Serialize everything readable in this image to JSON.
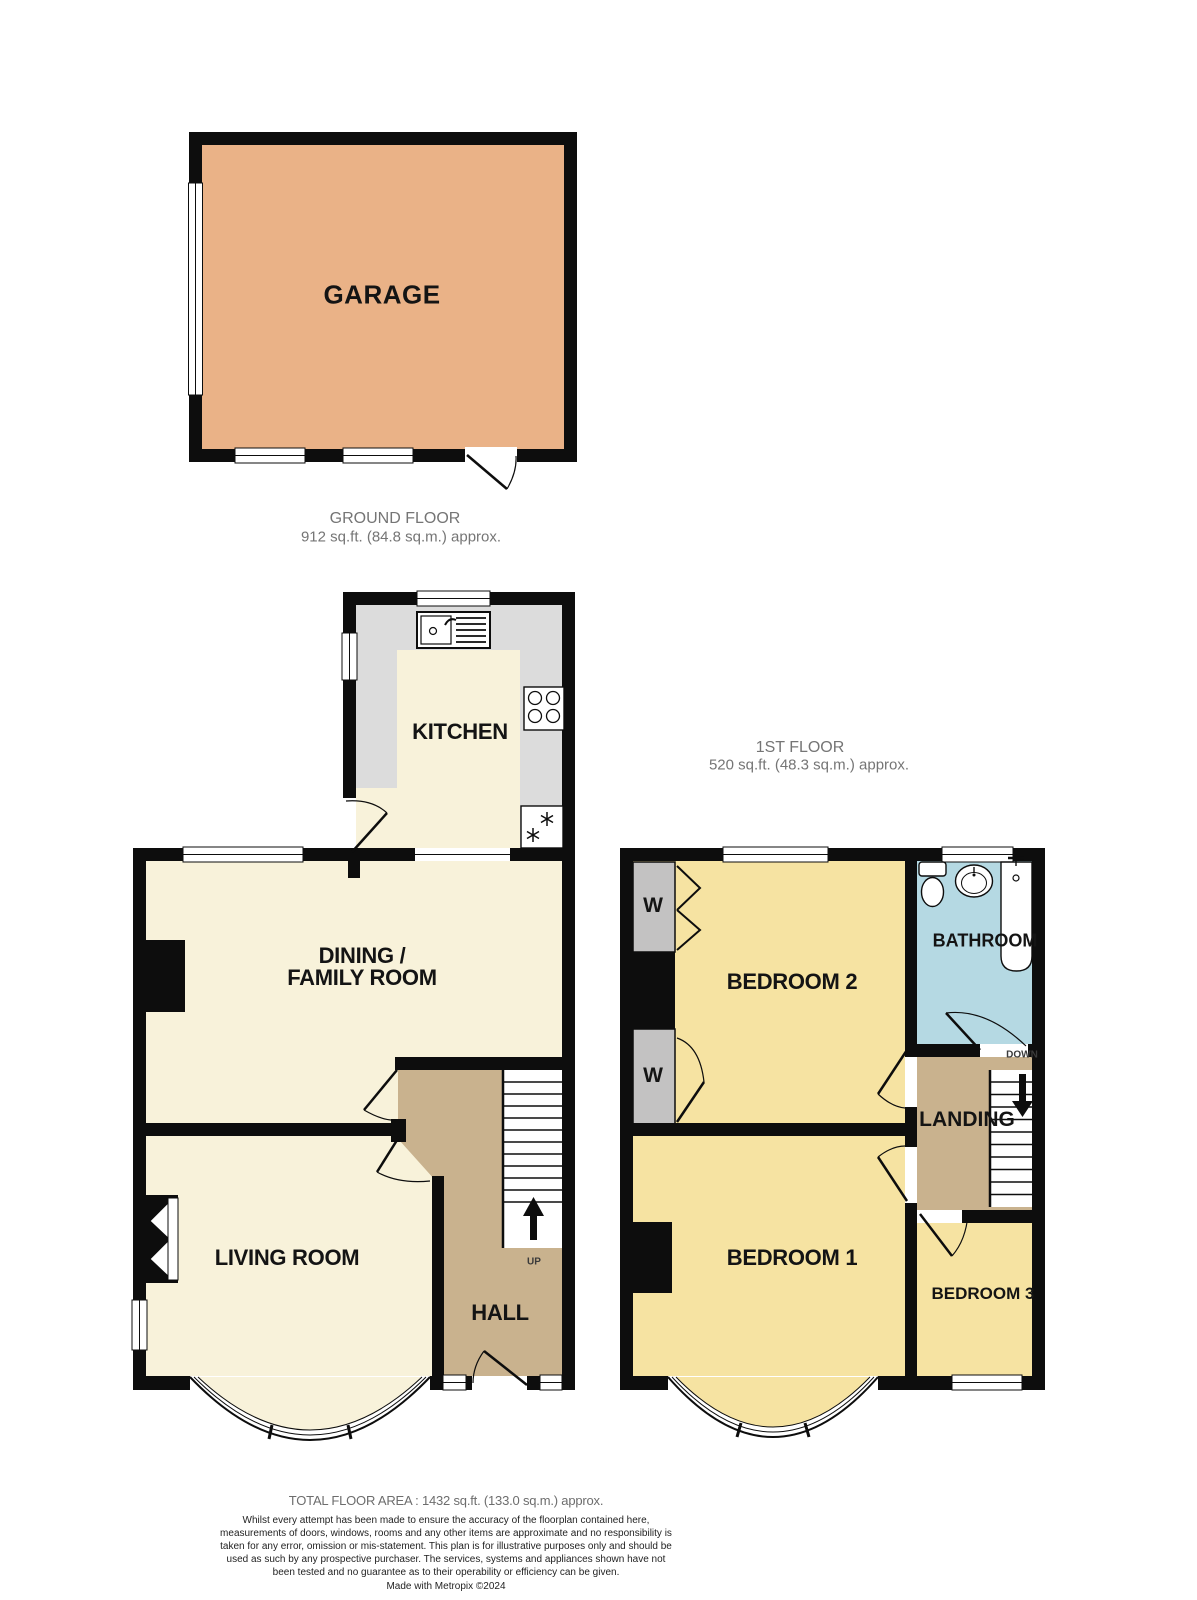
{
  "document": {
    "type": "floorplan"
  },
  "garage": {
    "label": "GARAGE"
  },
  "ground_floor": {
    "title": "GROUND FLOOR",
    "area": "912 sq.ft. (84.8 sq.m.) approx.",
    "rooms": {
      "kitchen": "KITCHEN",
      "dining_line1": "DINING /",
      "dining_line2": "FAMILY ROOM",
      "living": "LIVING ROOM",
      "hall": "HALL"
    },
    "stairs_label": "UP"
  },
  "first_floor": {
    "title": "1ST FLOOR",
    "area": "520 sq.ft. (48.3 sq.m.) approx.",
    "rooms": {
      "bedroom2": "BEDROOM 2",
      "bathroom": "BATHROOM",
      "landing": "LANDING",
      "bedroom1": "BEDROOM 1",
      "bedroom3": "BEDROOM 3",
      "wardrobe": "W"
    },
    "stairs_label": "DOWN"
  },
  "footer": {
    "total": "TOTAL FLOOR AREA : 1432 sq.ft. (133.0 sq.m.) approx.",
    "disclaimer": "Whilst every attempt has been made to ensure the accuracy of the floorplan contained here, measurements of doors, windows, rooms and any other items are approximate and no responsibility is taken for any error, omission or mis-statement. This plan is for illustrative purposes only and should be used as such by any prospective purchaser. The services, systems and appliances shown have not been tested and no guarantee as to their operability or efficiency can be given.",
    "made_with": "Made with Metropix ©2024"
  },
  "colors": {
    "wall": "#0d0d0d",
    "room_cream": "#f8f2da",
    "room_yellow": "#f6e3a2",
    "hall_tan": "#c9b28e",
    "bathroom_blue": "#b5d9e3",
    "garage_orange": "#eab287",
    "counter_grey": "#dcdcdc",
    "wardrobe_grey": "#c3c2c2"
  }
}
